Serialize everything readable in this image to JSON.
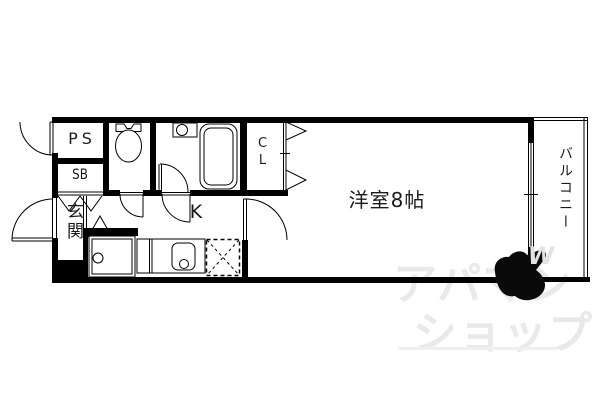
{
  "plan": {
    "rooms": {
      "ps": "PS",
      "sb": "SB",
      "entrance": "玄関",
      "kitchen": "K",
      "closet": "CL",
      "western_room": "洋室8帖",
      "balcony": "バルコニー"
    }
  },
  "watermark": {
    "line1": "アパマン",
    "line2": "ショップ",
    "wing": "W"
  },
  "colors": {
    "line": "#000000",
    "background": "#ffffff",
    "watermark": "#e9e9e9"
  }
}
